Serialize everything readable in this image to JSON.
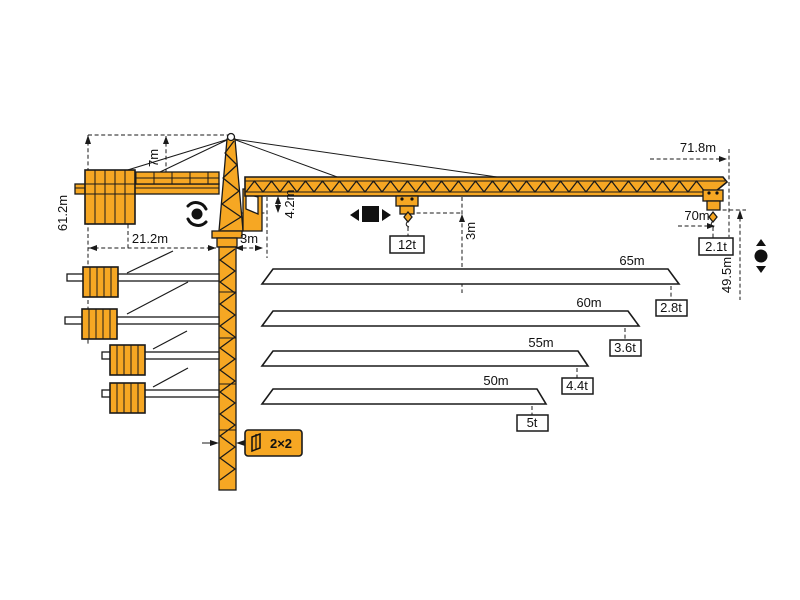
{
  "colors": {
    "crane_orange": "#F6A723",
    "line_black": "#1a1a1a",
    "background": "#ffffff"
  },
  "dimensions": {
    "tower_height": "61.2m",
    "head_height": "7m",
    "counter_jib_length": "21.2m",
    "counter_clearance": "3m",
    "jib_depth": "4.2m",
    "hook_clearance": "3m",
    "max_capacity": "12t",
    "jib_overall_length": "71.8m",
    "max_radius": "70m",
    "tip_capacity": "2.1t",
    "hook_height": "49.5m",
    "mast_section": "2×2"
  },
  "jib_variants": [
    {
      "length": "65m",
      "tip_capacity": "2.8t"
    },
    {
      "length": "60m",
      "tip_capacity": "3.6t"
    },
    {
      "length": "55m",
      "tip_capacity": "4.4t"
    },
    {
      "length": "50m",
      "tip_capacity": "5t"
    }
  ]
}
